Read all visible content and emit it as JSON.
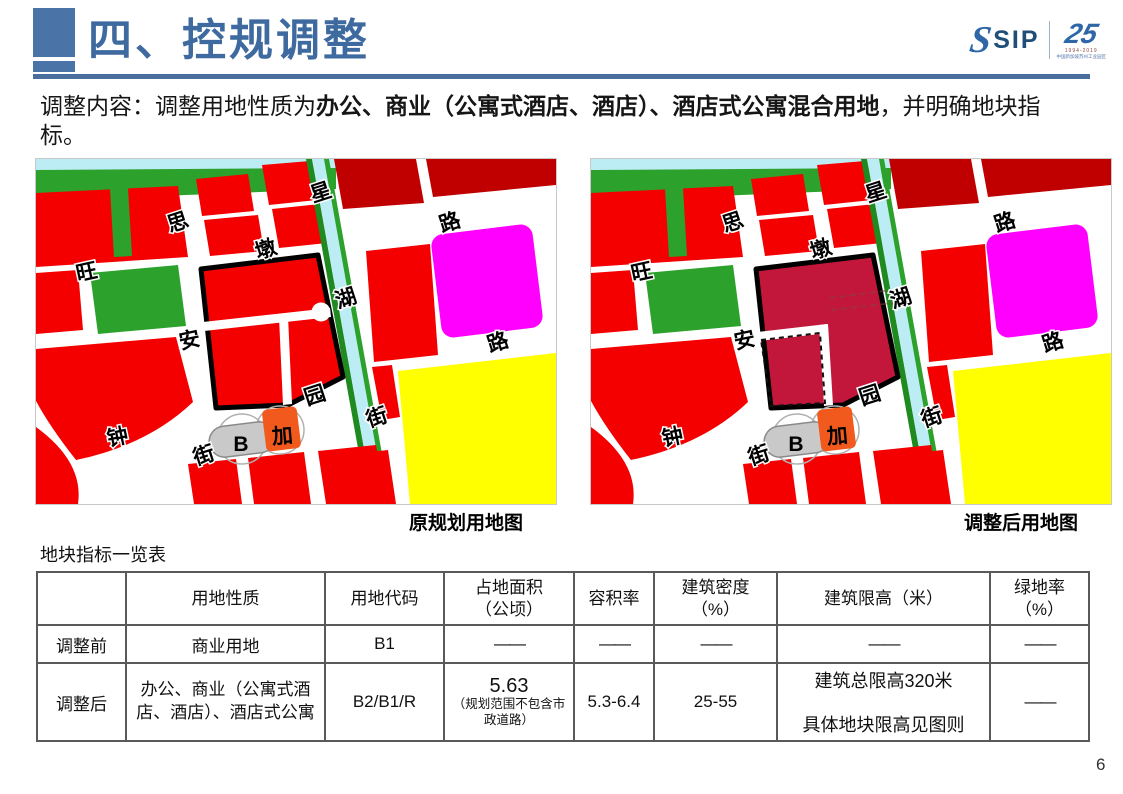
{
  "header": {
    "title": "四、控规调整",
    "logo": {
      "brand": "SIP",
      "swoosh": "S",
      "anniversary": "25",
      "years": "1994-2019",
      "org": "中国新加坡苏州工业园区"
    }
  },
  "intro": {
    "prefix": "调整内容：调整用地性质为",
    "bold": "办公、商业（公寓式酒店、酒店）、酒店式公寓混合用地",
    "suffix": "，并明确地块指标。"
  },
  "maps": {
    "left_caption": "原规划用地图",
    "right_caption": "调整后用地图",
    "colors": {
      "commercial_red": "#F40000",
      "dark_red": "#C00000",
      "park_green": "#2CA12C",
      "water_cyan": "#BDEDF4",
      "magenta": "#FF00FF",
      "yellow": "#FFFF00",
      "adjusted_parcel_crimson": "#C2173B",
      "marker_orange": "#F2591C"
    },
    "labels": [
      {
        "text": "思",
        "x": 144,
        "y": 70,
        "r": -18
      },
      {
        "text": "星",
        "x": 287,
        "y": 40,
        "r": -18
      },
      {
        "text": "路",
        "x": 416,
        "y": 70,
        "r": -18
      },
      {
        "text": "旺",
        "x": 52,
        "y": 120,
        "r": -12
      },
      {
        "text": "墩",
        "x": 232,
        "y": 97,
        "r": -18
      },
      {
        "text": "湖",
        "x": 312,
        "y": 146,
        "r": -18
      },
      {
        "text": "安",
        "x": 155,
        "y": 188,
        "r": -12
      },
      {
        "text": "路",
        "x": 464,
        "y": 190,
        "r": -18
      },
      {
        "text": "园",
        "x": 281,
        "y": 243,
        "r": -18
      },
      {
        "text": "街",
        "x": 343,
        "y": 265,
        "r": -18
      },
      {
        "text": "钟",
        "x": 83,
        "y": 285,
        "r": -12
      },
      {
        "text": "街",
        "x": 170,
        "y": 303,
        "r": -18
      },
      {
        "text": "B",
        "x": 205,
        "y": 292,
        "r": 0,
        "fs": 32,
        "fw": 600,
        "cls": "marker"
      },
      {
        "text": "加",
        "x": 247,
        "y": 284,
        "r": -5,
        "fs": 36,
        "fw": 700,
        "cls": "marker"
      }
    ]
  },
  "table": {
    "title": "地块指标一览表",
    "headers": [
      "",
      "用地性质",
      "用地代码",
      "占地面积\n（公顷）",
      "容积率",
      "建筑密度\n（%）",
      "建筑限高（米）",
      "绿地率\n（%）"
    ],
    "rows": {
      "before": {
        "label": "调整前",
        "nature": "商业用地",
        "code": "B1",
        "area": "——",
        "far": "——",
        "density": "——",
        "height": "——",
        "green": "——"
      },
      "after": {
        "label": "调整后",
        "nature": "办公、商业（公寓式酒店、酒店）、酒店式公寓",
        "code": "B2/B1/R",
        "area_value": "5.63",
        "area_note": "（规划范围不包含市政道路）",
        "far": "5.3-6.4",
        "density": "25-55",
        "height_line1": "建筑总限高320米",
        "height_line2": "具体地块限高见图则",
        "green": "——"
      }
    }
  },
  "page_number": "6"
}
